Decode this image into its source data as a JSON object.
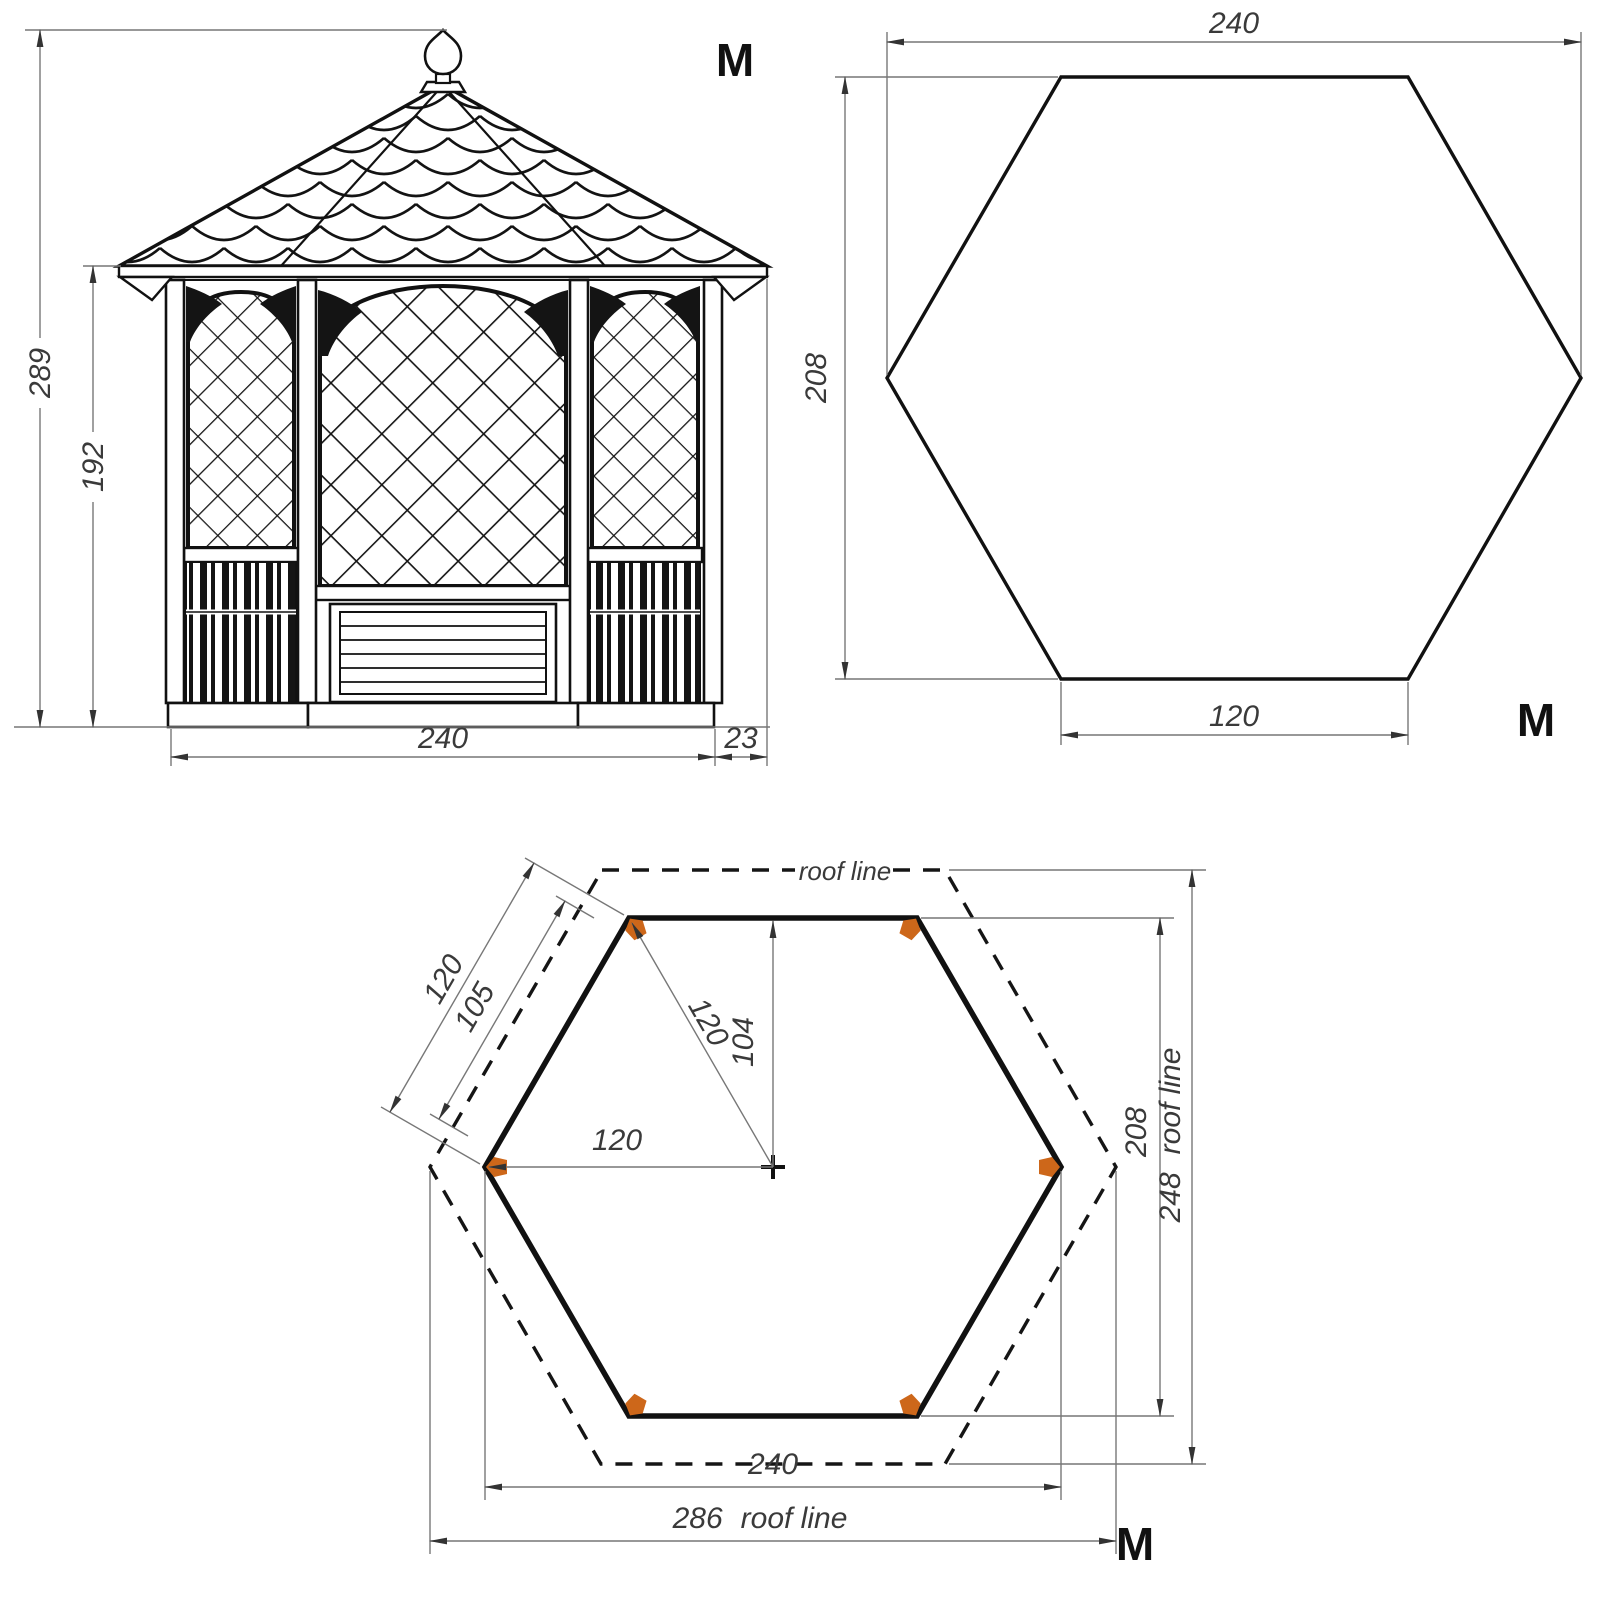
{
  "title": "Hexagonal gazebo technical drawing",
  "colors": {
    "line": "#111111",
    "thin_line": "#777777",
    "text": "#3a3a3a",
    "post_marker": "#cd671a",
    "background": "#ffffff"
  },
  "elevation": {
    "marker_label": "M",
    "dim_total_height": "289",
    "dim_wall_height": "192",
    "dim_width": "240",
    "dim_overhang": "23"
  },
  "plan": {
    "marker_label": "M",
    "dim_width": "240",
    "dim_height": "208",
    "dim_side": "120"
  },
  "foundation": {
    "marker_label": "M",
    "roof_line_label": "roof line",
    "dim_side": "120",
    "dim_panel": "105",
    "dim_radius": "120",
    "dim_apothem": "104",
    "dim_half_width": "120",
    "dim_height": "208",
    "dim_roof_height": "248",
    "dim_roof_height_label": "roof line",
    "dim_width": "240",
    "dim_roof_width": "286",
    "dim_roof_width_label": "roof line"
  }
}
